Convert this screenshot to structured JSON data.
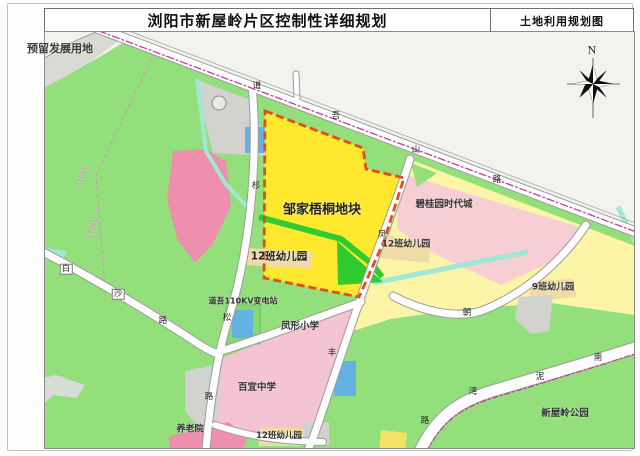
{
  "window": {
    "title": "浏阳市新屋岭片区控制性详细规划",
    "map_type_label": "土地利用规划图"
  },
  "compass": {
    "north_label": "N"
  },
  "colors": {
    "outside": "#f2f2ee",
    "plan_green": "#93df7c",
    "bright_green": "#2fcb2f",
    "block_yellow": "#ffe82d",
    "block_border": "#e04e1c",
    "pale_yellow": "#fcf4a6",
    "pale_pink": "#f7ced4",
    "west_pink": "#ef8fae",
    "school_pink": "#f4c3d4",
    "cream": "#f0dba6",
    "cyan": "#9fe8d5",
    "blue": "#64b2e2",
    "gray_parcel": "#d2d2cf",
    "pond_gray": "#d7dcd7",
    "road_casing": "#9b9b9b",
    "centerline_magenta": "#c53a9c",
    "powerline_pink": "#d885b8"
  },
  "map": {
    "area_labels": [
      {
        "text": "预留发展用地",
        "x": 60,
        "y": 48,
        "size": 11,
        "weight": 700,
        "color": "#3a3a3a"
      },
      {
        "text": "邹家梧桐地块",
        "x": 322,
        "y": 208,
        "size": 13,
        "weight": 700,
        "color": "#222"
      },
      {
        "text": "12班幼儿园",
        "x": 279,
        "y": 256,
        "size": 10.5,
        "weight": 700,
        "color": "#222"
      },
      {
        "text": "12班幼儿园",
        "x": 406,
        "y": 243,
        "size": 9,
        "weight": 600,
        "color": "#333"
      },
      {
        "text": "碧桂园时代城",
        "x": 444,
        "y": 203,
        "size": 9.5,
        "weight": 600,
        "color": "#333"
      },
      {
        "text": "9班幼儿园",
        "x": 553,
        "y": 286,
        "size": 9,
        "weight": 600,
        "color": "#333"
      },
      {
        "text": "道吾110KV变电站",
        "x": 243,
        "y": 301,
        "size": 8,
        "weight": 600,
        "color": "#333"
      },
      {
        "text": "凤形小学",
        "x": 300,
        "y": 325,
        "size": 9.5,
        "weight": 600,
        "color": "#333"
      },
      {
        "text": "百宜中学",
        "x": 257,
        "y": 386,
        "size": 9.5,
        "weight": 600,
        "color": "#333"
      },
      {
        "text": "养老院",
        "x": 190,
        "y": 428,
        "size": 9,
        "weight": 600,
        "color": "#333"
      },
      {
        "text": "12班幼儿园",
        "x": 279,
        "y": 435,
        "size": 8.5,
        "weight": 600,
        "color": "#333"
      },
      {
        "text": "新屋岭公园",
        "x": 565,
        "y": 412,
        "size": 9.5,
        "weight": 600,
        "color": "#333"
      },
      {
        "text": "110KV",
        "x": 82,
        "y": 176,
        "size": 7,
        "weight": 400,
        "color": "#d885b8",
        "rot": -68
      },
      {
        "text": "110KV",
        "x": 93,
        "y": 228,
        "size": 7,
        "weight": 400,
        "color": "#d885b8",
        "rot": -68
      }
    ],
    "road_labels": [
      {
        "text": "道",
        "x": 257,
        "y": 86
      },
      {
        "text": "吾",
        "x": 336,
        "y": 116
      },
      {
        "text": "山",
        "x": 416,
        "y": 150
      },
      {
        "text": "路",
        "x": 497,
        "y": 180
      },
      {
        "text": "白",
        "x": 66,
        "y": 269,
        "boxed": true
      },
      {
        "text": "沙",
        "x": 118,
        "y": 294,
        "boxed": true
      },
      {
        "text": "路",
        "x": 163,
        "y": 321
      },
      {
        "text": "杉",
        "x": 256,
        "y": 186
      },
      {
        "text": "松",
        "x": 227,
        "y": 318
      },
      {
        "text": "路",
        "x": 209,
        "y": 397
      },
      {
        "text": "凤",
        "x": 382,
        "y": 235
      },
      {
        "text": "丰",
        "x": 332,
        "y": 353
      },
      {
        "text": "朝",
        "x": 467,
        "y": 313
      },
      {
        "text": "南",
        "x": 598,
        "y": 358
      },
      {
        "text": "泥",
        "x": 540,
        "y": 377
      },
      {
        "text": "湾",
        "x": 473,
        "y": 392
      },
      {
        "text": "路",
        "x": 425,
        "y": 421
      }
    ]
  }
}
